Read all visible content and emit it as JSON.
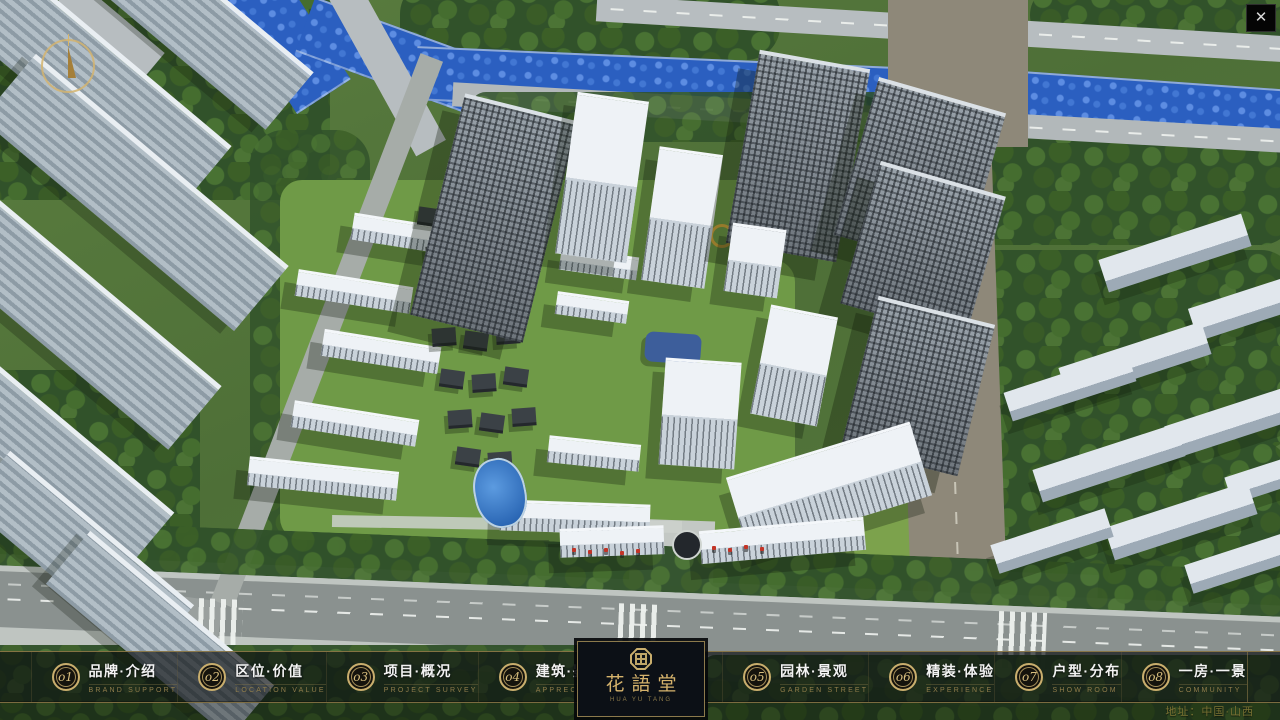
{
  "nav": {
    "items": [
      {
        "num": "o1",
        "label": "品牌·介绍",
        "sub": "BRAND SUPPORT"
      },
      {
        "num": "o2",
        "label": "区位·价值",
        "sub": "LOCATION VALUE"
      },
      {
        "num": "o3",
        "label": "项目·概况",
        "sub": "PROJECT SURVEY"
      },
      {
        "num": "o4",
        "label": "建筑·鉴赏",
        "sub": "APPRECIATION"
      },
      {
        "num": "o5",
        "label": "园林·景观",
        "sub": "GARDEN STREET"
      },
      {
        "num": "o6",
        "label": "精装·体验",
        "sub": "EXPERIENCE"
      },
      {
        "num": "o7",
        "label": "户型·分布",
        "sub": "SHOW ROOM"
      },
      {
        "num": "o8",
        "label": "一房·一景",
        "sub": "COMMUNITY"
      }
    ]
  },
  "logo": {
    "name": "花語堂",
    "subtitle": "HUA YU TANG"
  },
  "footer": {
    "address": "地址：中国·山西"
  },
  "window": {
    "close_label": "✕"
  },
  "colors": {
    "accent_gold": "#c9ae6d",
    "bar_background": "rgba(10,13,15,0.66)",
    "river_blue": "#2b5fc0",
    "foliage_green": "#3c6028"
  }
}
